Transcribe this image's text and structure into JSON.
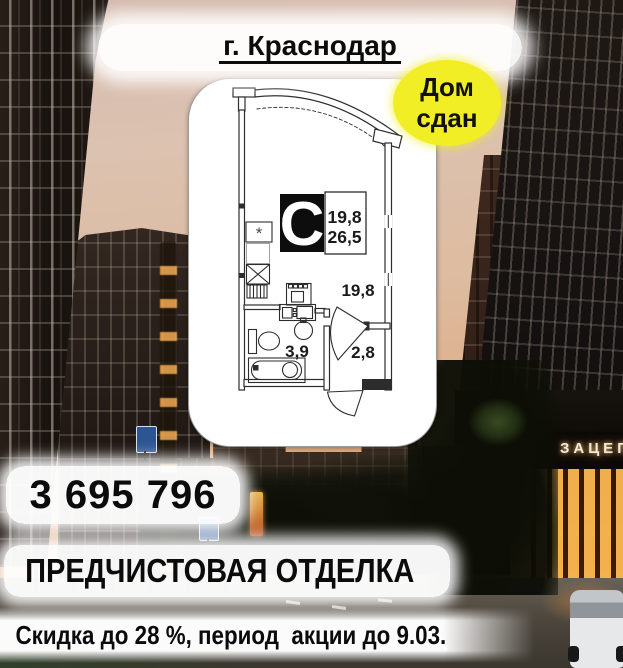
{
  "title": {
    "city": "г. Краснодар"
  },
  "badge": {
    "line1": "Дом",
    "line2": "сдан"
  },
  "plan": {
    "type_letter": "C",
    "living_area": "19,8",
    "total_area": "26,5",
    "room_area_label": "19,8",
    "bathroom_area_label": "3,9",
    "hallway_area_label": "2,8",
    "appliance_mark": "*"
  },
  "price": {
    "value": "3 695 796"
  },
  "finishing": {
    "label": "ПРЕДЧИСТОВАЯ ОТДЕЛКА"
  },
  "promo": {
    "label": "Скидка до 28 %, период  акции до 9.03."
  },
  "background": {
    "storefront_sign": "ЗАЦЕП"
  },
  "colors": {
    "badge_yellow": "#f2ee25",
    "banner_white": "#ffffff",
    "text_black": "#0b0b0b"
  }
}
